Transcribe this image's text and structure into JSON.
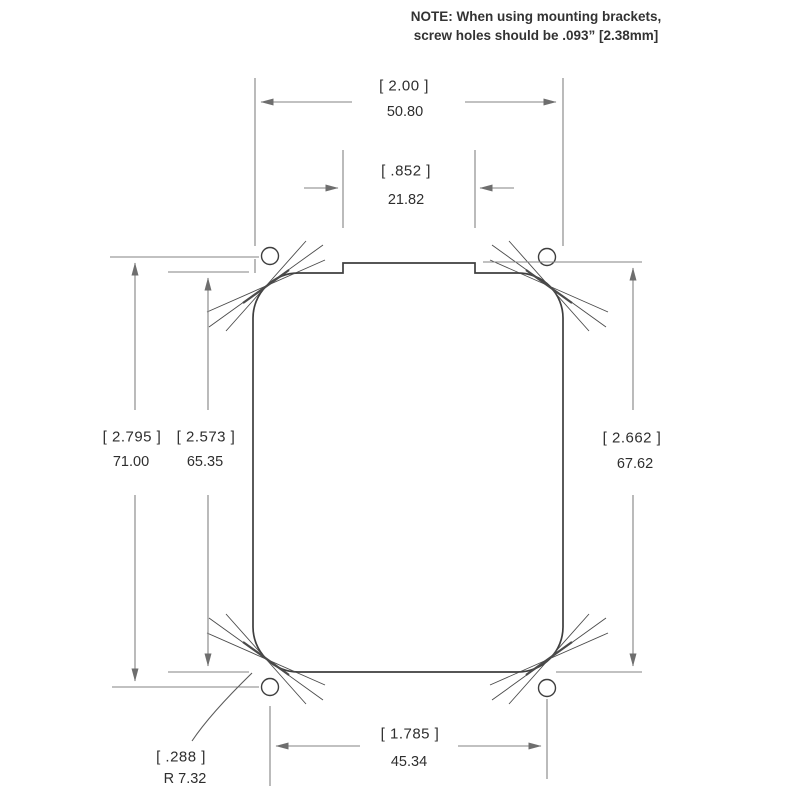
{
  "note": {
    "line1": "NOTE: When using mounting brackets,",
    "line2": "screw holes should be .093” [2.38mm]"
  },
  "dims": {
    "overall_width": {
      "in": "[ 2.00 ]",
      "mm": "50.80"
    },
    "notch_width": {
      "in": "[ .852 ]",
      "mm": "21.82"
    },
    "hole_span_vertical": {
      "in": "[ 2.795 ]",
      "mm": "71.00"
    },
    "cutout_height": {
      "in": "[ 2.573 ]",
      "mm": "65.35"
    },
    "right_height": {
      "in": "[ 2.662 ]",
      "mm": "67.62"
    },
    "hole_span_horizontal": {
      "in": "[ 1.785 ]",
      "mm": "45.34"
    },
    "corner_radius": {
      "in": "[ .288 ]",
      "mm": "R 7.32"
    }
  },
  "colors": {
    "outline": "#3e3e3e",
    "dimension_line": "#838383",
    "text": "#2e2e2e"
  }
}
